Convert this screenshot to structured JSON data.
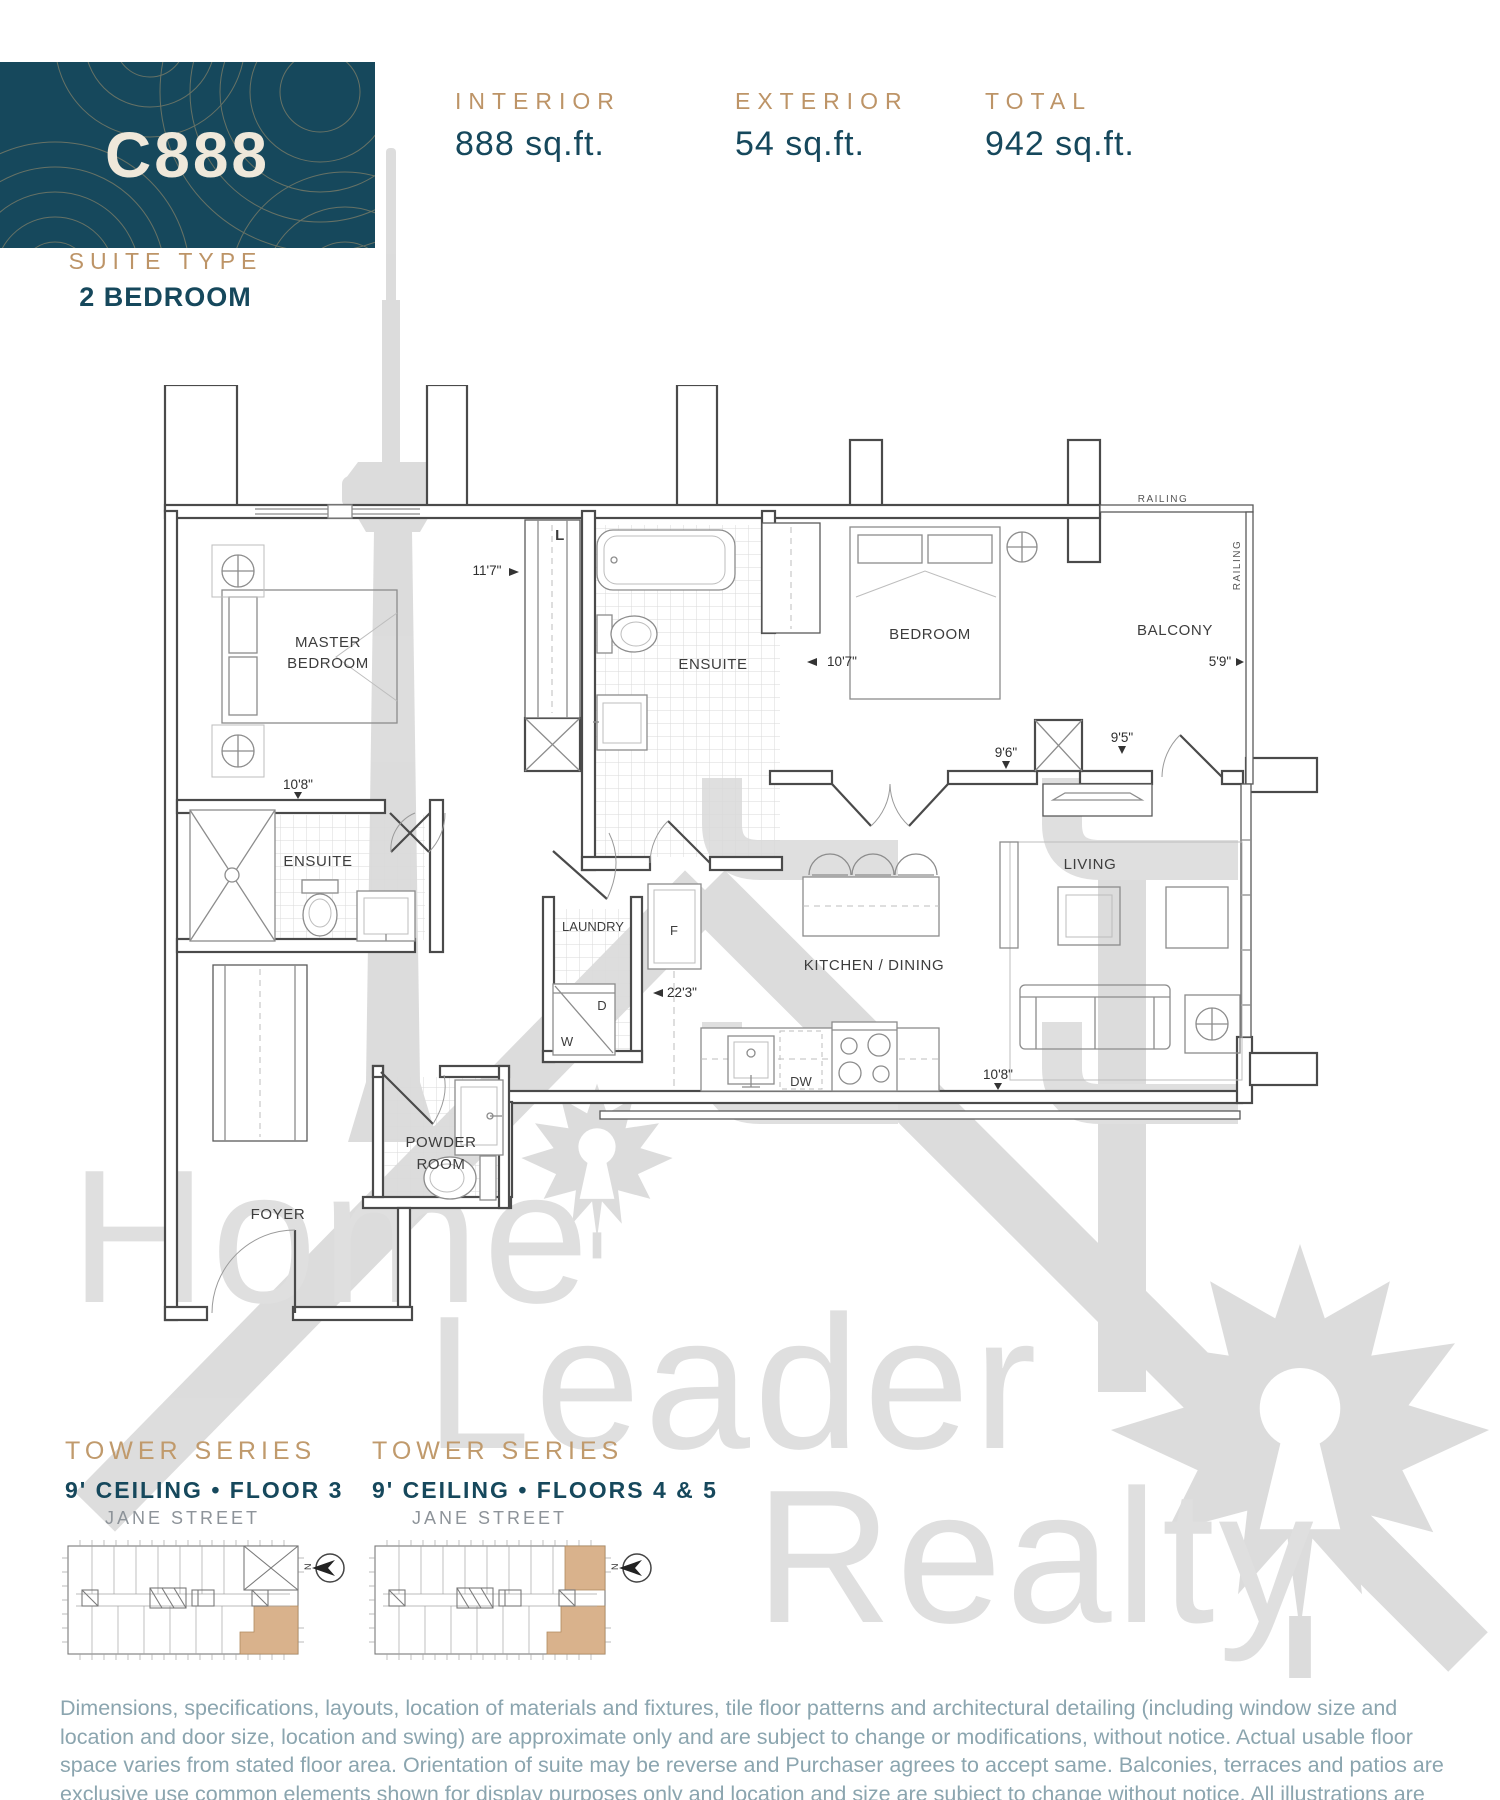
{
  "suite": {
    "code": "C888",
    "type_label": "SUITE TYPE",
    "type_value": "2 BEDROOM"
  },
  "areas": {
    "interior": {
      "label": "INTERIOR",
      "value": "888 sq.ft."
    },
    "exterior": {
      "label": "EXTERIOR",
      "value": "54 sq.ft."
    },
    "total": {
      "label": "TOTAL",
      "value": "942 sq.ft."
    }
  },
  "plan": {
    "labels": {
      "master_bedroom_1": "MASTER",
      "master_bedroom_2": "BEDROOM",
      "ensuite_upper": "ENSUITE",
      "ensuite_master": "ENSUITE",
      "bedroom": "BEDROOM",
      "balcony": "BALCONY",
      "railing_top": "RAILING",
      "railing_right": "RAILING",
      "laundry": "LAUNDRY",
      "kitchen_dining": "KITCHEN / DINING",
      "living": "LIVING",
      "powder_1": "POWDER",
      "powder_2": "ROOM",
      "foyer": "FOYER",
      "linen": "L",
      "fridge": "F",
      "dryer": "D",
      "washer": "W",
      "dishwasher": "DW"
    },
    "dims": {
      "master_len": "11'7\"",
      "master_w": "10'8\"",
      "bedroom": "10'7\"",
      "hall_w": "9'6\"",
      "balcony_w": "9'5\"",
      "balcony_d": "5'9\"",
      "suite_len": "22'3\"",
      "living_w": "10'8\""
    }
  },
  "keyplans": {
    "first": {
      "series": "TOWER SERIES",
      "ceiling": "9' CEILING • FLOOR 3",
      "street": "JANE STREET",
      "north": "N"
    },
    "second": {
      "series": "TOWER SERIES",
      "ceiling": "9' CEILING • FLOORS 4 & 5",
      "street": "JANE STREET",
      "north": "N"
    }
  },
  "watermark": {
    "words": [
      "Home",
      "Leader",
      "Realty"
    ]
  },
  "disclaimer": {
    "line1": "Dimensions, specifications, layouts, location of materials and fixtures, tile floor patterns and architectural detailing (including window size and",
    "line2": "location and door size, location and swing) are approximate only and are subject to change or modifications, without notice. Actual usable floor",
    "line3": "space varies from stated floor area. Orientation of suite may be reverse and Purchaser agrees to accept same. Balconies, terraces and patios are",
    "line4": "exclusive use common elements shown for display purposes only and location and size are subject to change without notice. All illustrations are",
    "line5": "artist concept only. The provisions of Schedule “X” of this Agreement, including Section 6 and 38 apply to this Schedule. E. & O.E. June 2021"
  },
  "colors": {
    "teal": "#16485c",
    "gold": "#bd9467",
    "key_highlight": "#d9b28c",
    "watermark": "#d9d9d9",
    "disclaimer": "#8ba5af"
  }
}
